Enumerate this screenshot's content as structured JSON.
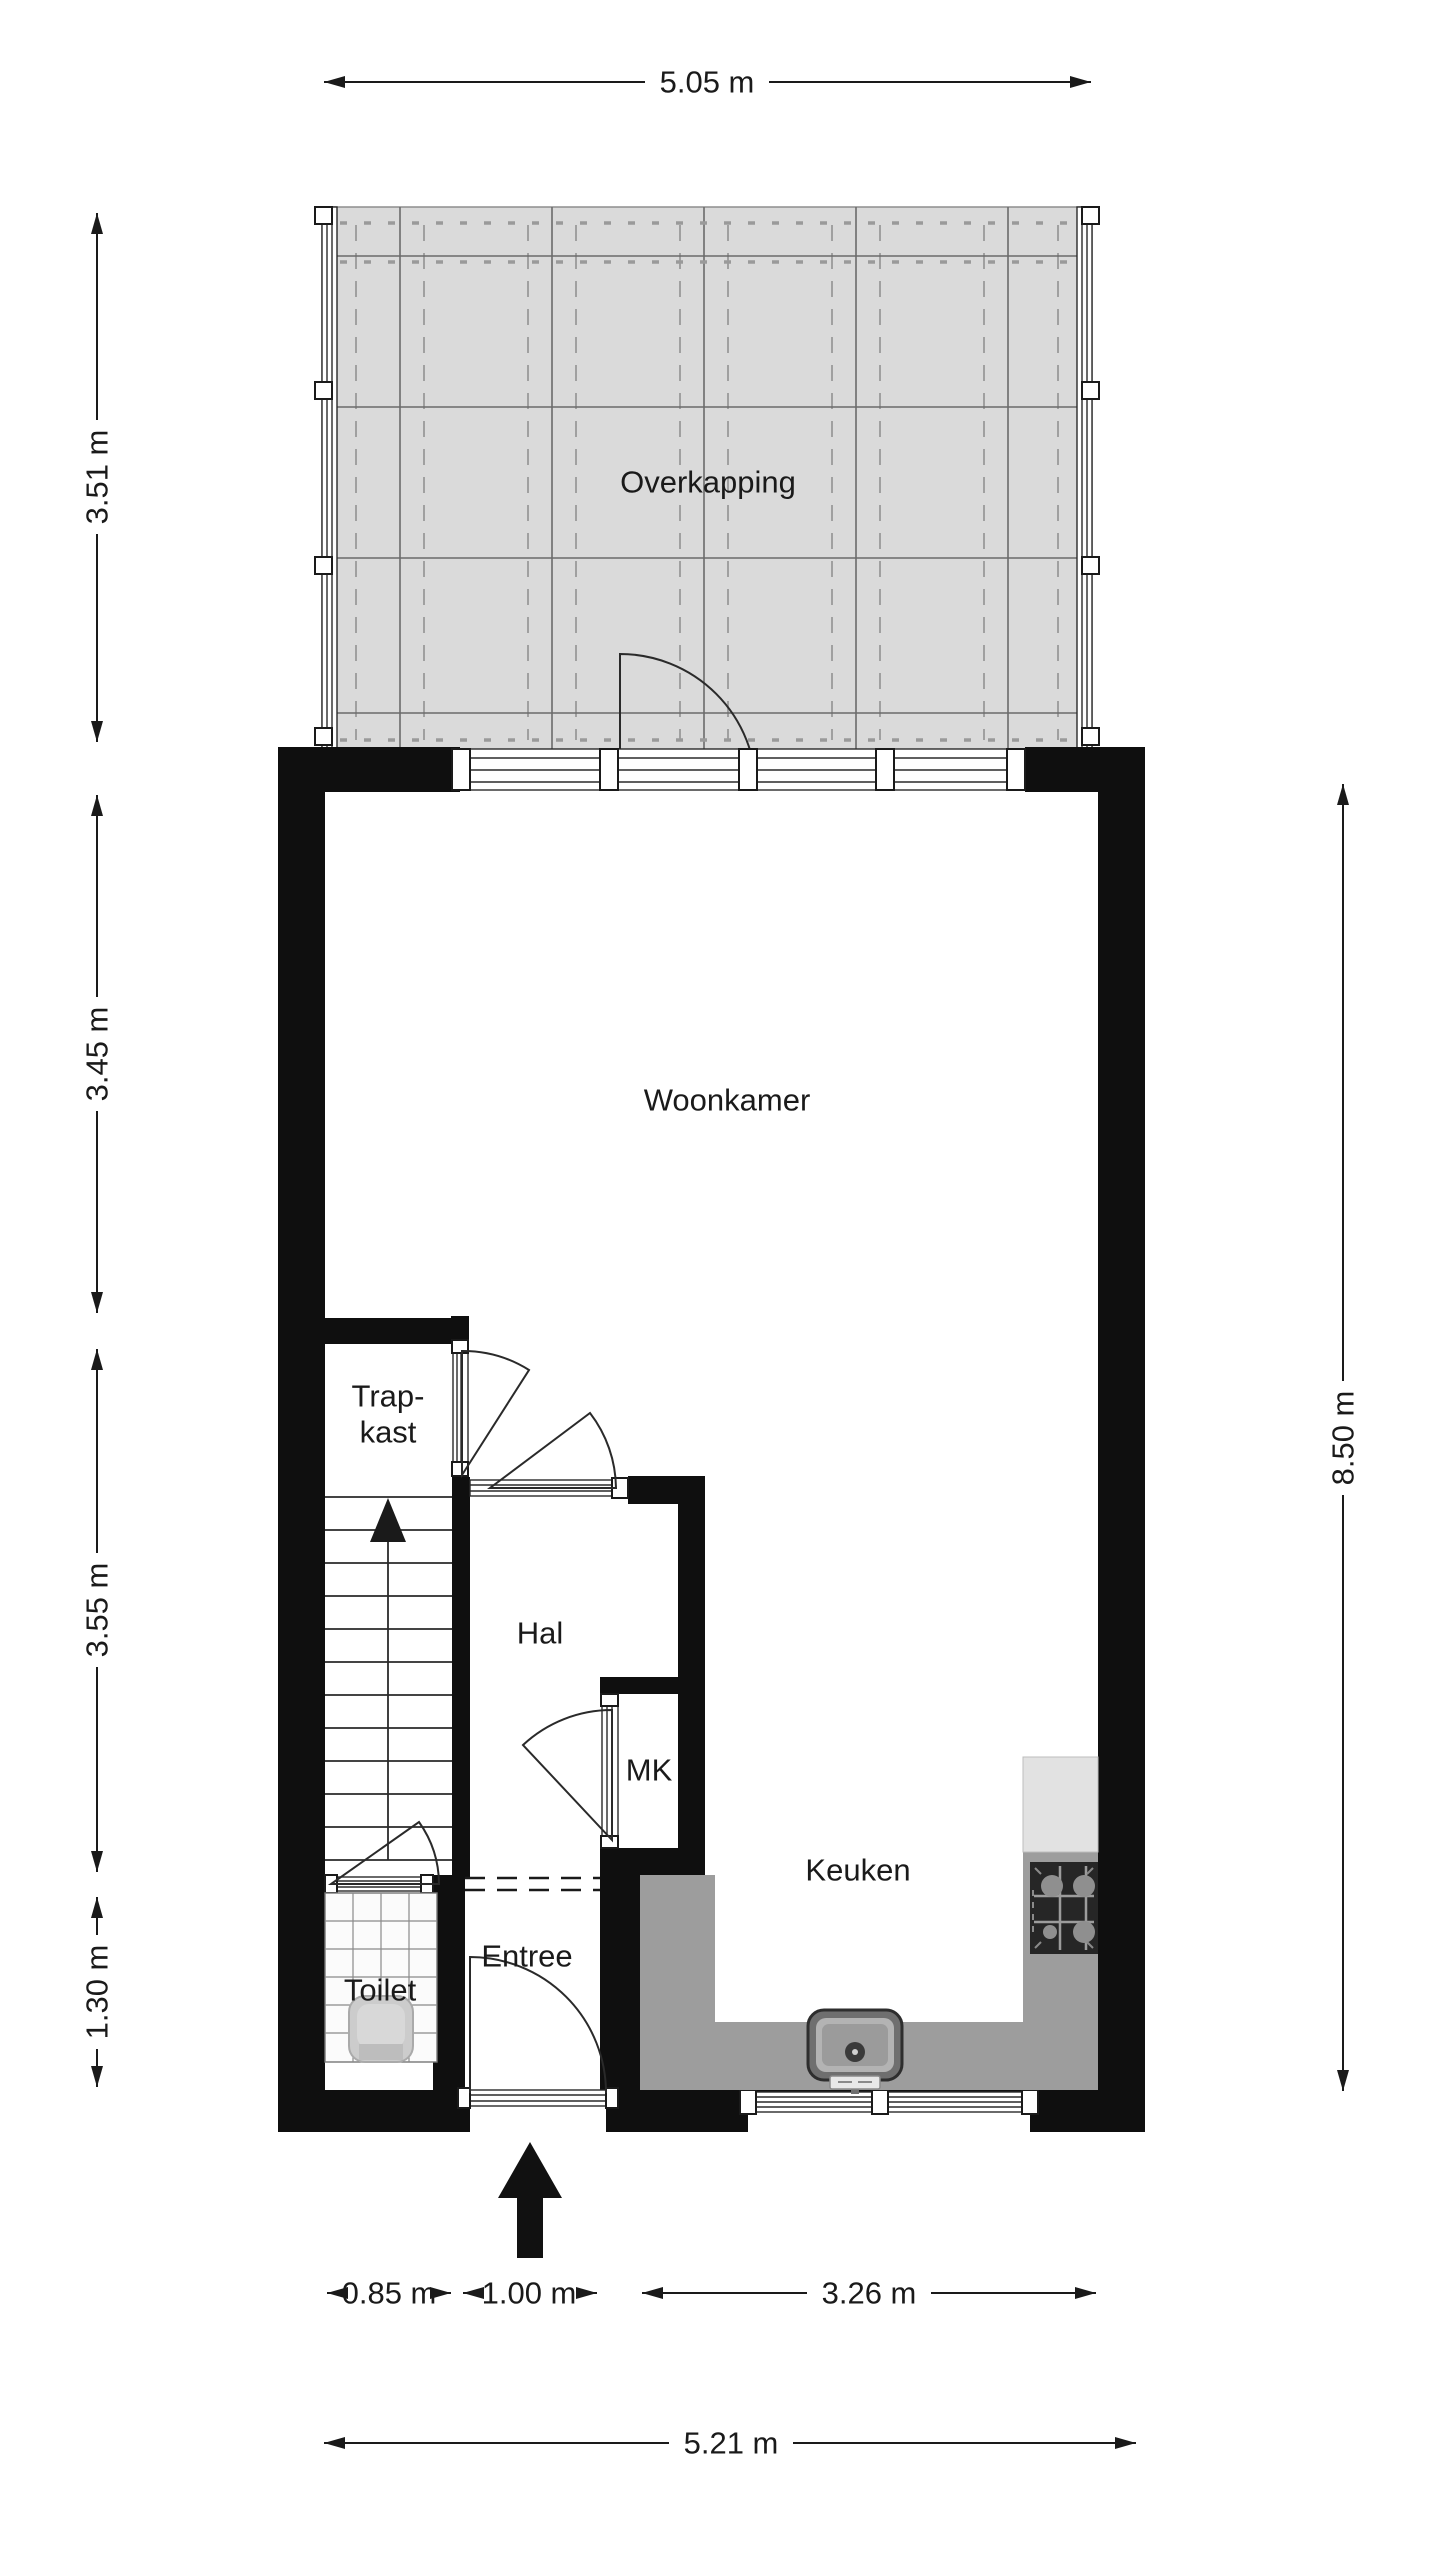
{
  "floorplan": {
    "rooms": {
      "overkapping": "Overkapping",
      "woonkamer": "Woonkamer",
      "trapkast_line1": "Trap-",
      "trapkast_line2": "kast",
      "hal": "Hal",
      "mk": "MK",
      "keuken": "Keuken",
      "entree": "Entree",
      "toilet": "Toilet"
    },
    "dimensions": {
      "top_width": "5.05 m",
      "left_overkapping": "3.51 m",
      "left_woonkamer": "3.45 m",
      "left_hal": "3.55 m",
      "left_toilet": "1.30 m",
      "right_height": "8.50 m",
      "bottom_toilet": "0.85 m",
      "bottom_entree": "1.00 m",
      "bottom_keuken": "3.26 m",
      "bottom_width": "5.21 m"
    },
    "colors": {
      "wall": "#0f0f0f",
      "overkapping_fill": "#dadada",
      "counter_fill": "#9d9d9d",
      "appliance_fill": "#e2e2e2",
      "stove_fill": "#262626",
      "burner_fill": "#8f8f8f",
      "fixture_fill": "#cccccc",
      "background": "#ffffff"
    }
  }
}
